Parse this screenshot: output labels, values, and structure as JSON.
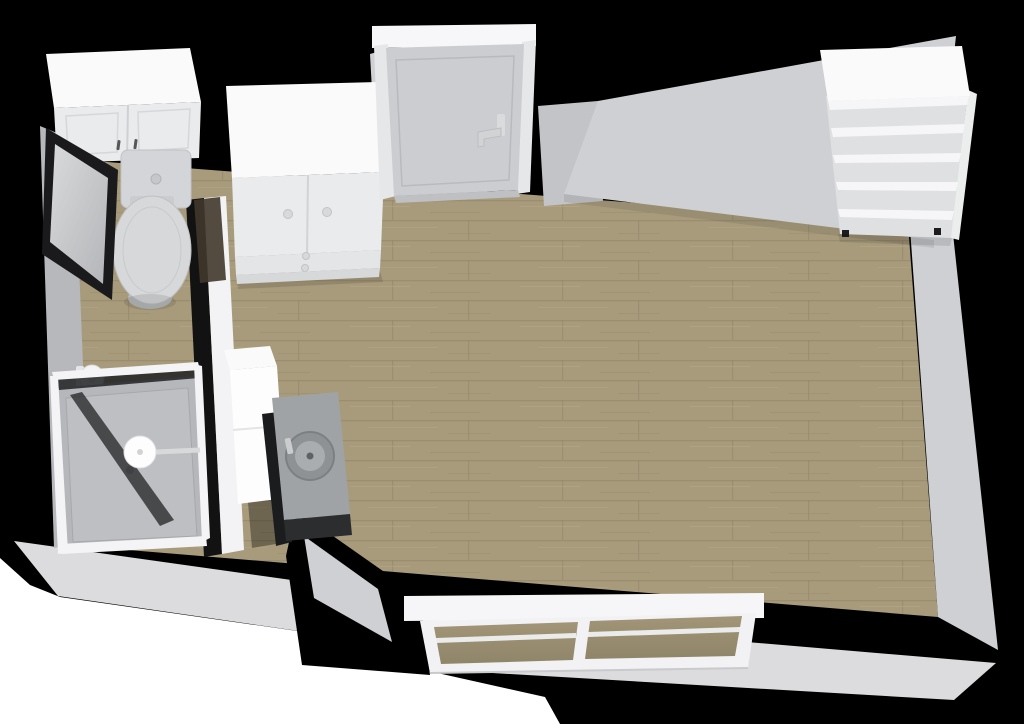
{
  "app": {
    "type": "3d-floorplan-render",
    "view": "top-down isometric cutaway",
    "description": "3D rendered floor plan of a studio apartment: bathroom on the left with wall cabinet, toilet, mirror, toilet-paper holder and glass shower; main room with wood plank floor, sideboard cabinet, entry door, tall cabinet with concrete sink counter, open shelving unit, and a wide two-pane window on the bottom wall.",
    "canvas": {
      "width": 1024,
      "height": 724
    }
  },
  "palette": {
    "bg": "#ffffff",
    "wall-black": "#000000",
    "wall-light": "#cfd0d3",
    "wall-mid": "#c3c4c7",
    "wall-dark": "#b7b8bb",
    "exterior": "#dcdcde",
    "floor-wood": "#a89b7c",
    "floor-seam": "#8f8265",
    "floor-grain-light": "#b7aa8a",
    "floor-grain-dark": "#978a6b",
    "furniture-white": "#fafafb",
    "furniture-front": "#eaebed",
    "door-gray": "#cbcdd1",
    "tray-gray": "#b5b7ba",
    "counter-gray": "#a0a3a6",
    "counter-dark": "#2c2d2f",
    "basin-gray": "#8f9295",
    "mirror-frame": "#1a1a1c",
    "glass-dark": "#202123",
    "pane-wood": "#a29578",
    "wood-walltop": "#43382c",
    "hardware-dark": "#55565a",
    "knob-gray": "#d8d9db"
  },
  "scene": {
    "rooms": [
      {
        "name": "bathroom",
        "floor": "wood planks",
        "fixtures": [
          "wall cabinet with two doors",
          "toilet with cistern",
          "framed mirror",
          "toilet paper holder",
          "glass shower enclosure with round shower head"
        ]
      },
      {
        "name": "main room",
        "floor": "wood planks",
        "fixtures": [
          "sideboard cabinet with two doors and drawers",
          "entry door with lever handle",
          "tall white cabinet",
          "concrete counter with round sink",
          "open shelving unit with five shelves",
          "two-pane window"
        ]
      }
    ],
    "objects": [
      {
        "id": "wall-cabinet",
        "label": "bathroom wall cabinet",
        "doors": 2
      },
      {
        "id": "toilet",
        "label": "toilet with closed lid"
      },
      {
        "id": "mirror",
        "label": "dark framed wall mirror"
      },
      {
        "id": "tp-holder",
        "label": "toilet paper holder"
      },
      {
        "id": "shower",
        "label": "glass shower enclosure",
        "head": "round rain shower head"
      },
      {
        "id": "partition-wall",
        "label": "bathroom partition wall"
      },
      {
        "id": "sideboard",
        "label": "white sideboard",
        "doors": 2,
        "drawers": 2
      },
      {
        "id": "entry-door",
        "label": "entry door",
        "handle": "lever, right side"
      },
      {
        "id": "tall-cabinet",
        "label": "tall white cabinet"
      },
      {
        "id": "sink-counter",
        "label": "concrete counter with round basin and faucet"
      },
      {
        "id": "shelf-unit",
        "label": "open shelving unit",
        "shelves": 5
      },
      {
        "id": "window",
        "label": "two-pane window on bottom wall",
        "panes": 2
      }
    ]
  }
}
